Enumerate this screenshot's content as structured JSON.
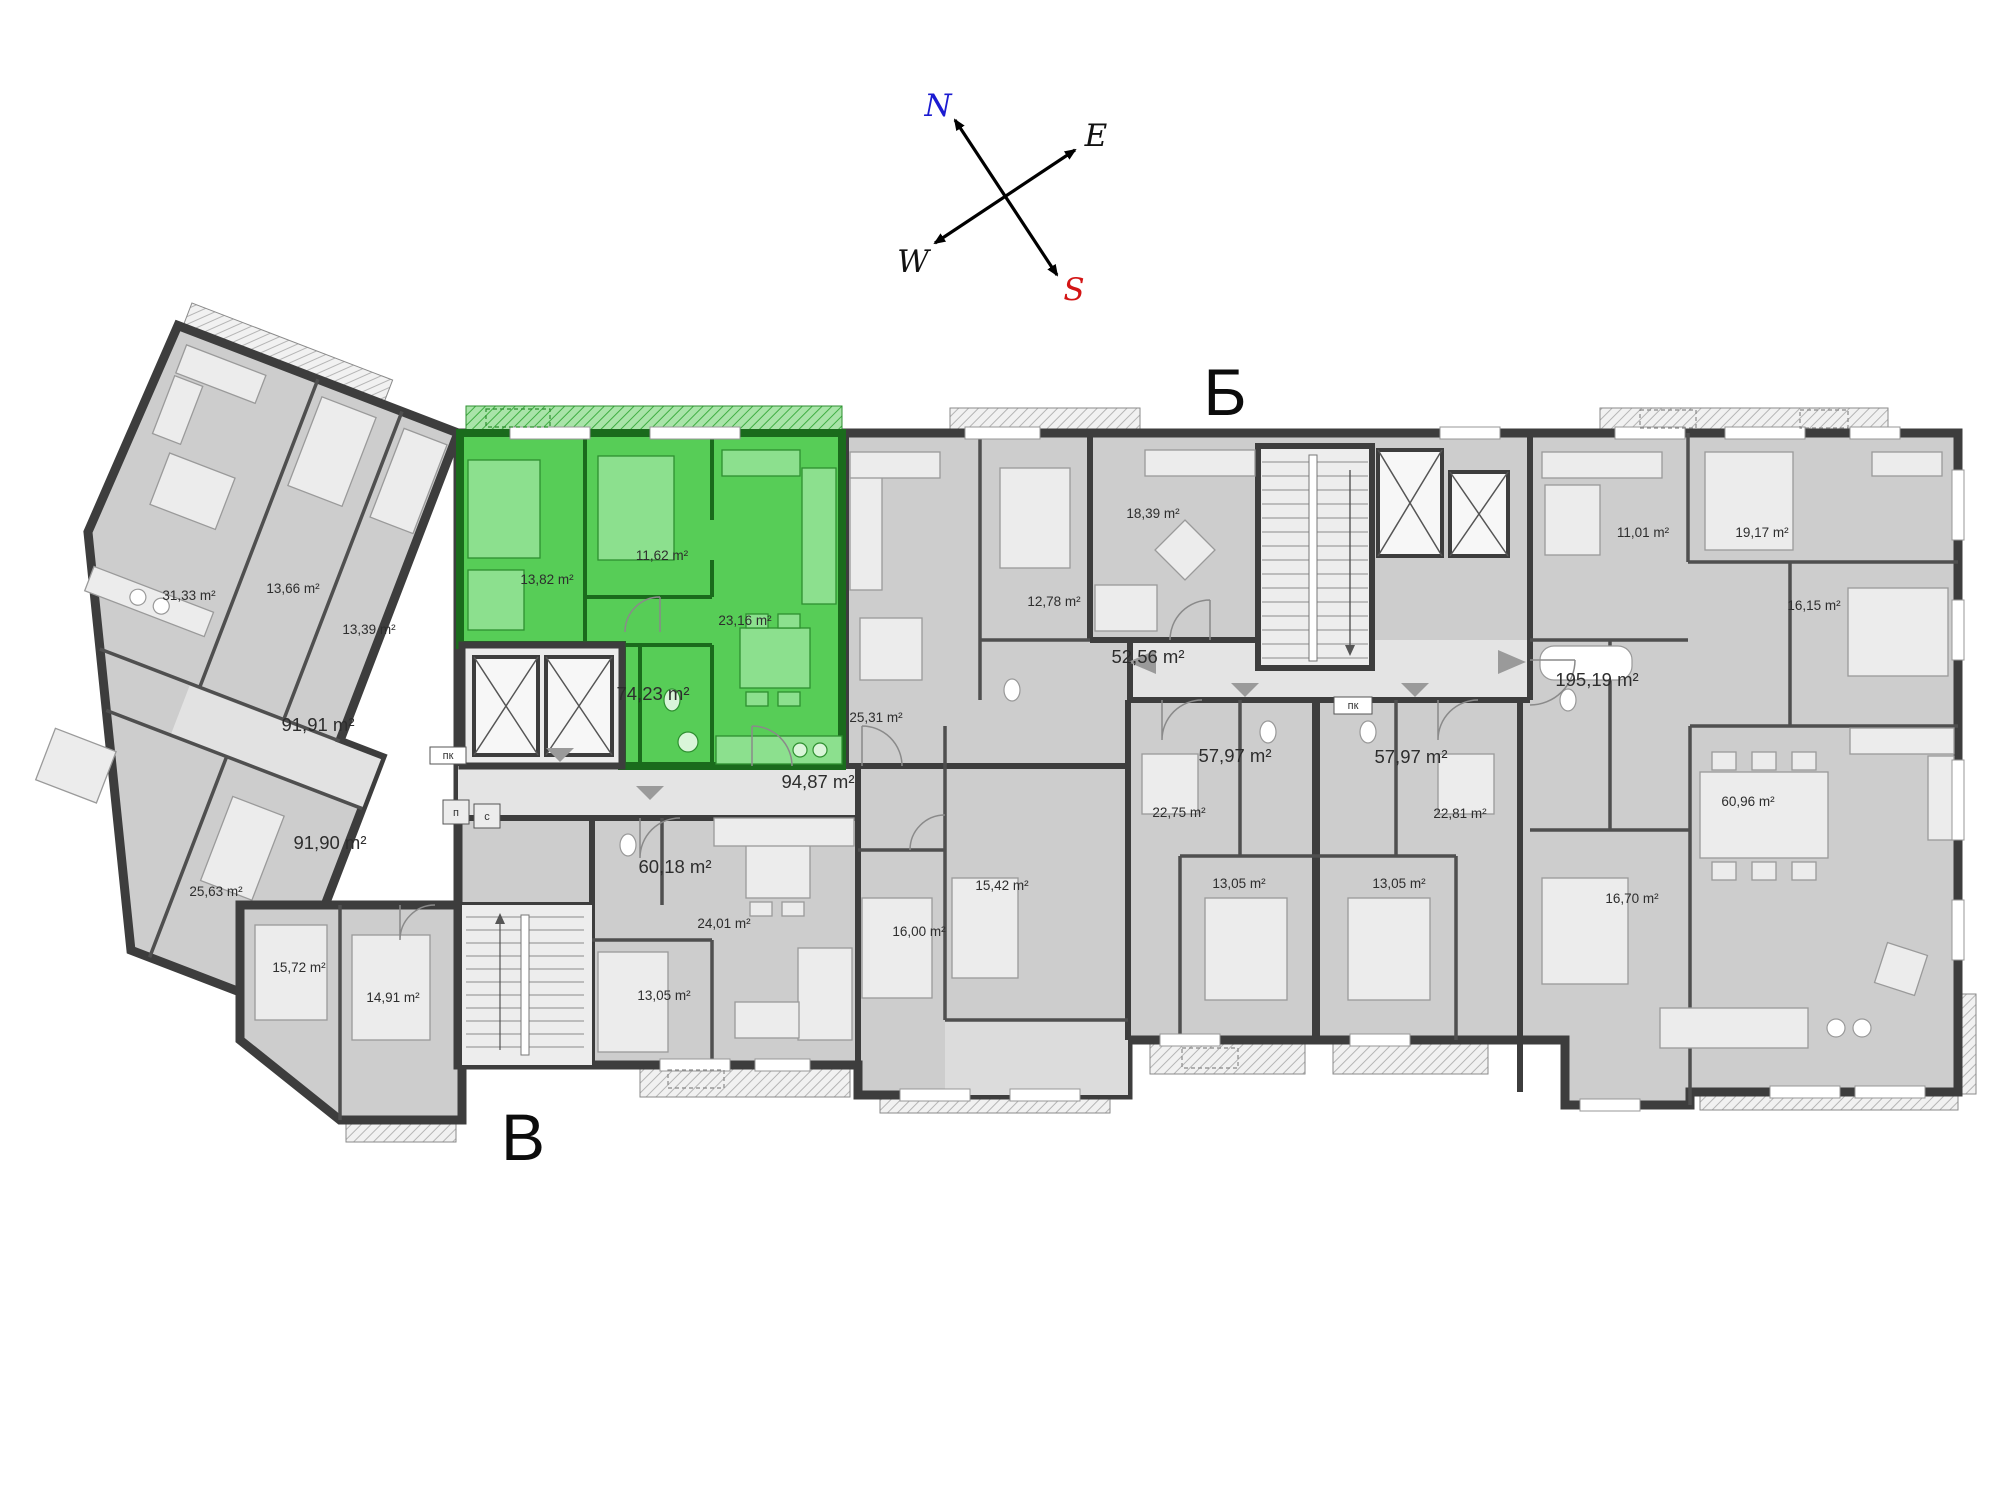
{
  "colors": {
    "floor": "#cdcdcd",
    "corridor": "#e4e4e4",
    "wall": "#3d3d3d",
    "highlight_floor": "#57cd57",
    "highlight_wall": "#1a6b1c",
    "north_letter": "#1b1bd1",
    "south_letter": "#d31515"
  },
  "compass": {
    "labels": [
      {
        "text": "N",
        "x": 938,
        "y": 116,
        "color": "#1b1bd1"
      },
      {
        "text": "E",
        "x": 1096,
        "y": 146,
        "color": "#111111"
      },
      {
        "text": "W",
        "x": 913,
        "y": 272,
        "color": "#111111"
      },
      {
        "text": "S",
        "x": 1074,
        "y": 300,
        "color": "#d31515"
      }
    ]
  },
  "sections": [
    {
      "text": "Б",
      "x": 1225,
      "y": 415
    },
    {
      "text": "В",
      "x": 523,
      "y": 1160
    }
  ],
  "highlighted_unit": {
    "total_label": "74,23 m²",
    "room_labels": [
      "13,82 m²",
      "11,62 m²",
      "23,16 m²"
    ]
  },
  "area_labels": [
    {
      "text": "31,33 m²",
      "x": 189,
      "y": 600,
      "size": "sm"
    },
    {
      "text": "13,66 m²",
      "x": 293,
      "y": 593,
      "size": "sm"
    },
    {
      "text": "13,39 m²",
      "x": 369,
      "y": 634,
      "size": "sm"
    },
    {
      "text": "91,91 m²",
      "x": 318,
      "y": 731,
      "size": "lg"
    },
    {
      "text": "91,90 m²",
      "x": 330,
      "y": 849,
      "size": "lg"
    },
    {
      "text": "25,63 m²",
      "x": 216,
      "y": 896,
      "size": "sm"
    },
    {
      "text": "15,72 m²",
      "x": 299,
      "y": 972,
      "size": "sm"
    },
    {
      "text": "14,91 m²",
      "x": 393,
      "y": 1002,
      "size": "sm"
    },
    {
      "text": "13,82 m²",
      "x": 547,
      "y": 584,
      "size": "sm"
    },
    {
      "text": "11,62 m²",
      "x": 662,
      "y": 560,
      "size": "sm"
    },
    {
      "text": "23,16 m²",
      "x": 745,
      "y": 625,
      "size": "sm"
    },
    {
      "text": "74,23 m²",
      "x": 653,
      "y": 700,
      "size": "lg",
      "color": "#e4ece4"
    },
    {
      "text": "94,87 m²",
      "x": 818,
      "y": 788,
      "size": "lg"
    },
    {
      "text": "60,18 m²",
      "x": 675,
      "y": 873,
      "size": "lg"
    },
    {
      "text": "24,01 m²",
      "x": 724,
      "y": 928,
      "size": "sm"
    },
    {
      "text": "13,05 m²",
      "x": 664,
      "y": 1000,
      "size": "sm"
    },
    {
      "text": "25,31 m²",
      "x": 876,
      "y": 722,
      "size": "sm"
    },
    {
      "text": "12,78 m²",
      "x": 1054,
      "y": 606,
      "size": "sm"
    },
    {
      "text": "16,00 m²",
      "x": 919,
      "y": 936,
      "size": "sm"
    },
    {
      "text": "15,42 m²",
      "x": 1002,
      "y": 890,
      "size": "sm"
    },
    {
      "text": "18,39 m²",
      "x": 1153,
      "y": 518,
      "size": "sm"
    },
    {
      "text": "52,56 m²",
      "x": 1148,
      "y": 663,
      "size": "lg"
    },
    {
      "text": "57,97 m²",
      "x": 1235,
      "y": 762,
      "size": "lg"
    },
    {
      "text": "57,97 m²",
      "x": 1411,
      "y": 763,
      "size": "lg"
    },
    {
      "text": "22,75 m²",
      "x": 1179,
      "y": 817,
      "size": "sm"
    },
    {
      "text": "22,81 m²",
      "x": 1460,
      "y": 818,
      "size": "sm"
    },
    {
      "text": "13,05 m²",
      "x": 1239,
      "y": 888,
      "size": "sm"
    },
    {
      "text": "13,05 m²",
      "x": 1399,
      "y": 888,
      "size": "sm"
    },
    {
      "text": "11,01 m²",
      "x": 1643,
      "y": 537,
      "size": "sm"
    },
    {
      "text": "19,17 m²",
      "x": 1762,
      "y": 537,
      "size": "sm"
    },
    {
      "text": "16,15 m²",
      "x": 1814,
      "y": 610,
      "size": "sm"
    },
    {
      "text": "195,19 m²",
      "x": 1597,
      "y": 686,
      "size": "lg"
    },
    {
      "text": "60,96 m²",
      "x": 1748,
      "y": 806,
      "size": "sm"
    },
    {
      "text": "16,70 m²",
      "x": 1632,
      "y": 903,
      "size": "sm"
    }
  ],
  "tiny_labels": [
    {
      "text": "пк",
      "x": 448,
      "y": 759
    },
    {
      "text": "пк",
      "x": 1353,
      "y": 709
    },
    {
      "text": "п",
      "x": 456,
      "y": 816
    },
    {
      "text": "с",
      "x": 487,
      "y": 820
    }
  ]
}
